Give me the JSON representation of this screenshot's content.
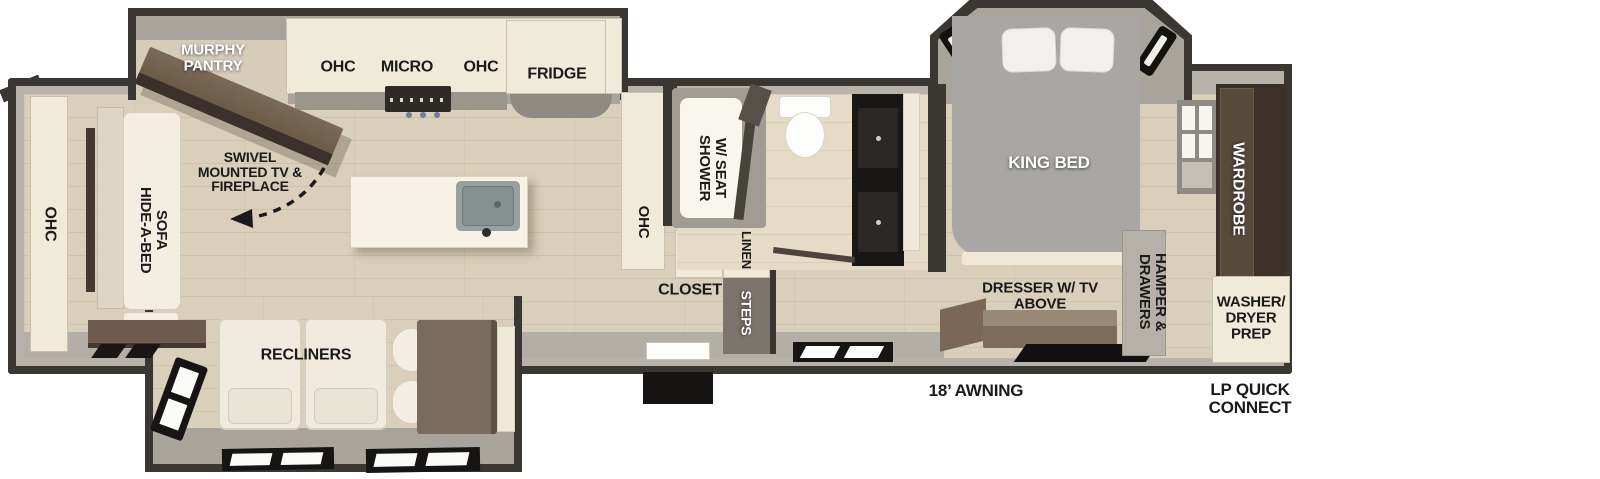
{
  "labels": {
    "murphy_pantry": "MURPHY PANTRY",
    "kitchen_ohc_left": "OHC",
    "kitchen_micro": "MICRO",
    "kitchen_ohc_right": "OHC",
    "kitchen_fridge": "FRIDGE",
    "swivel_tv": "SWIVEL MOUNTED TV & FIREPLACE",
    "front_ohc": "OHC",
    "hide_a_bed_sofa": "HIDE-A-BED SOFA",
    "recliners": "RECLINERS",
    "mid_ohc": "OHC",
    "closet": "CLOSET",
    "linen": "LINEN",
    "steps": "STEPS",
    "shower": "SHOWER W/ SEAT",
    "king_bed": "KING BED",
    "dresser_tv": "DRESSER W/ TV ABOVE",
    "hamper_drawers": "HAMPER & DRAWERS",
    "wardrobe": "WARDROBE",
    "washer_dryer_prep": "WASHER/ DRYER PREP",
    "awning": "18’ AWNING",
    "lp_quick_connect": "LP QUICK CONNECT"
  },
  "colors": {
    "background": "#ffffff",
    "wall_dark": "#3a3733",
    "wall_light": "#b7b3aa",
    "floor_wood": "#d9cfba",
    "floor_tile": "#e5dcc8",
    "slide_floor": "#a8a49c",
    "cabinet_cream": "#f0ead9",
    "furniture_white": "#f1ece0",
    "wood_brown": "#6f5b4e",
    "wardrobe_brown": "#3b3128",
    "bed_gray": "#a9a7a3",
    "vanity_black": "#181715",
    "label_black": "#1a1a1a",
    "label_white": "#ffffff"
  }
}
